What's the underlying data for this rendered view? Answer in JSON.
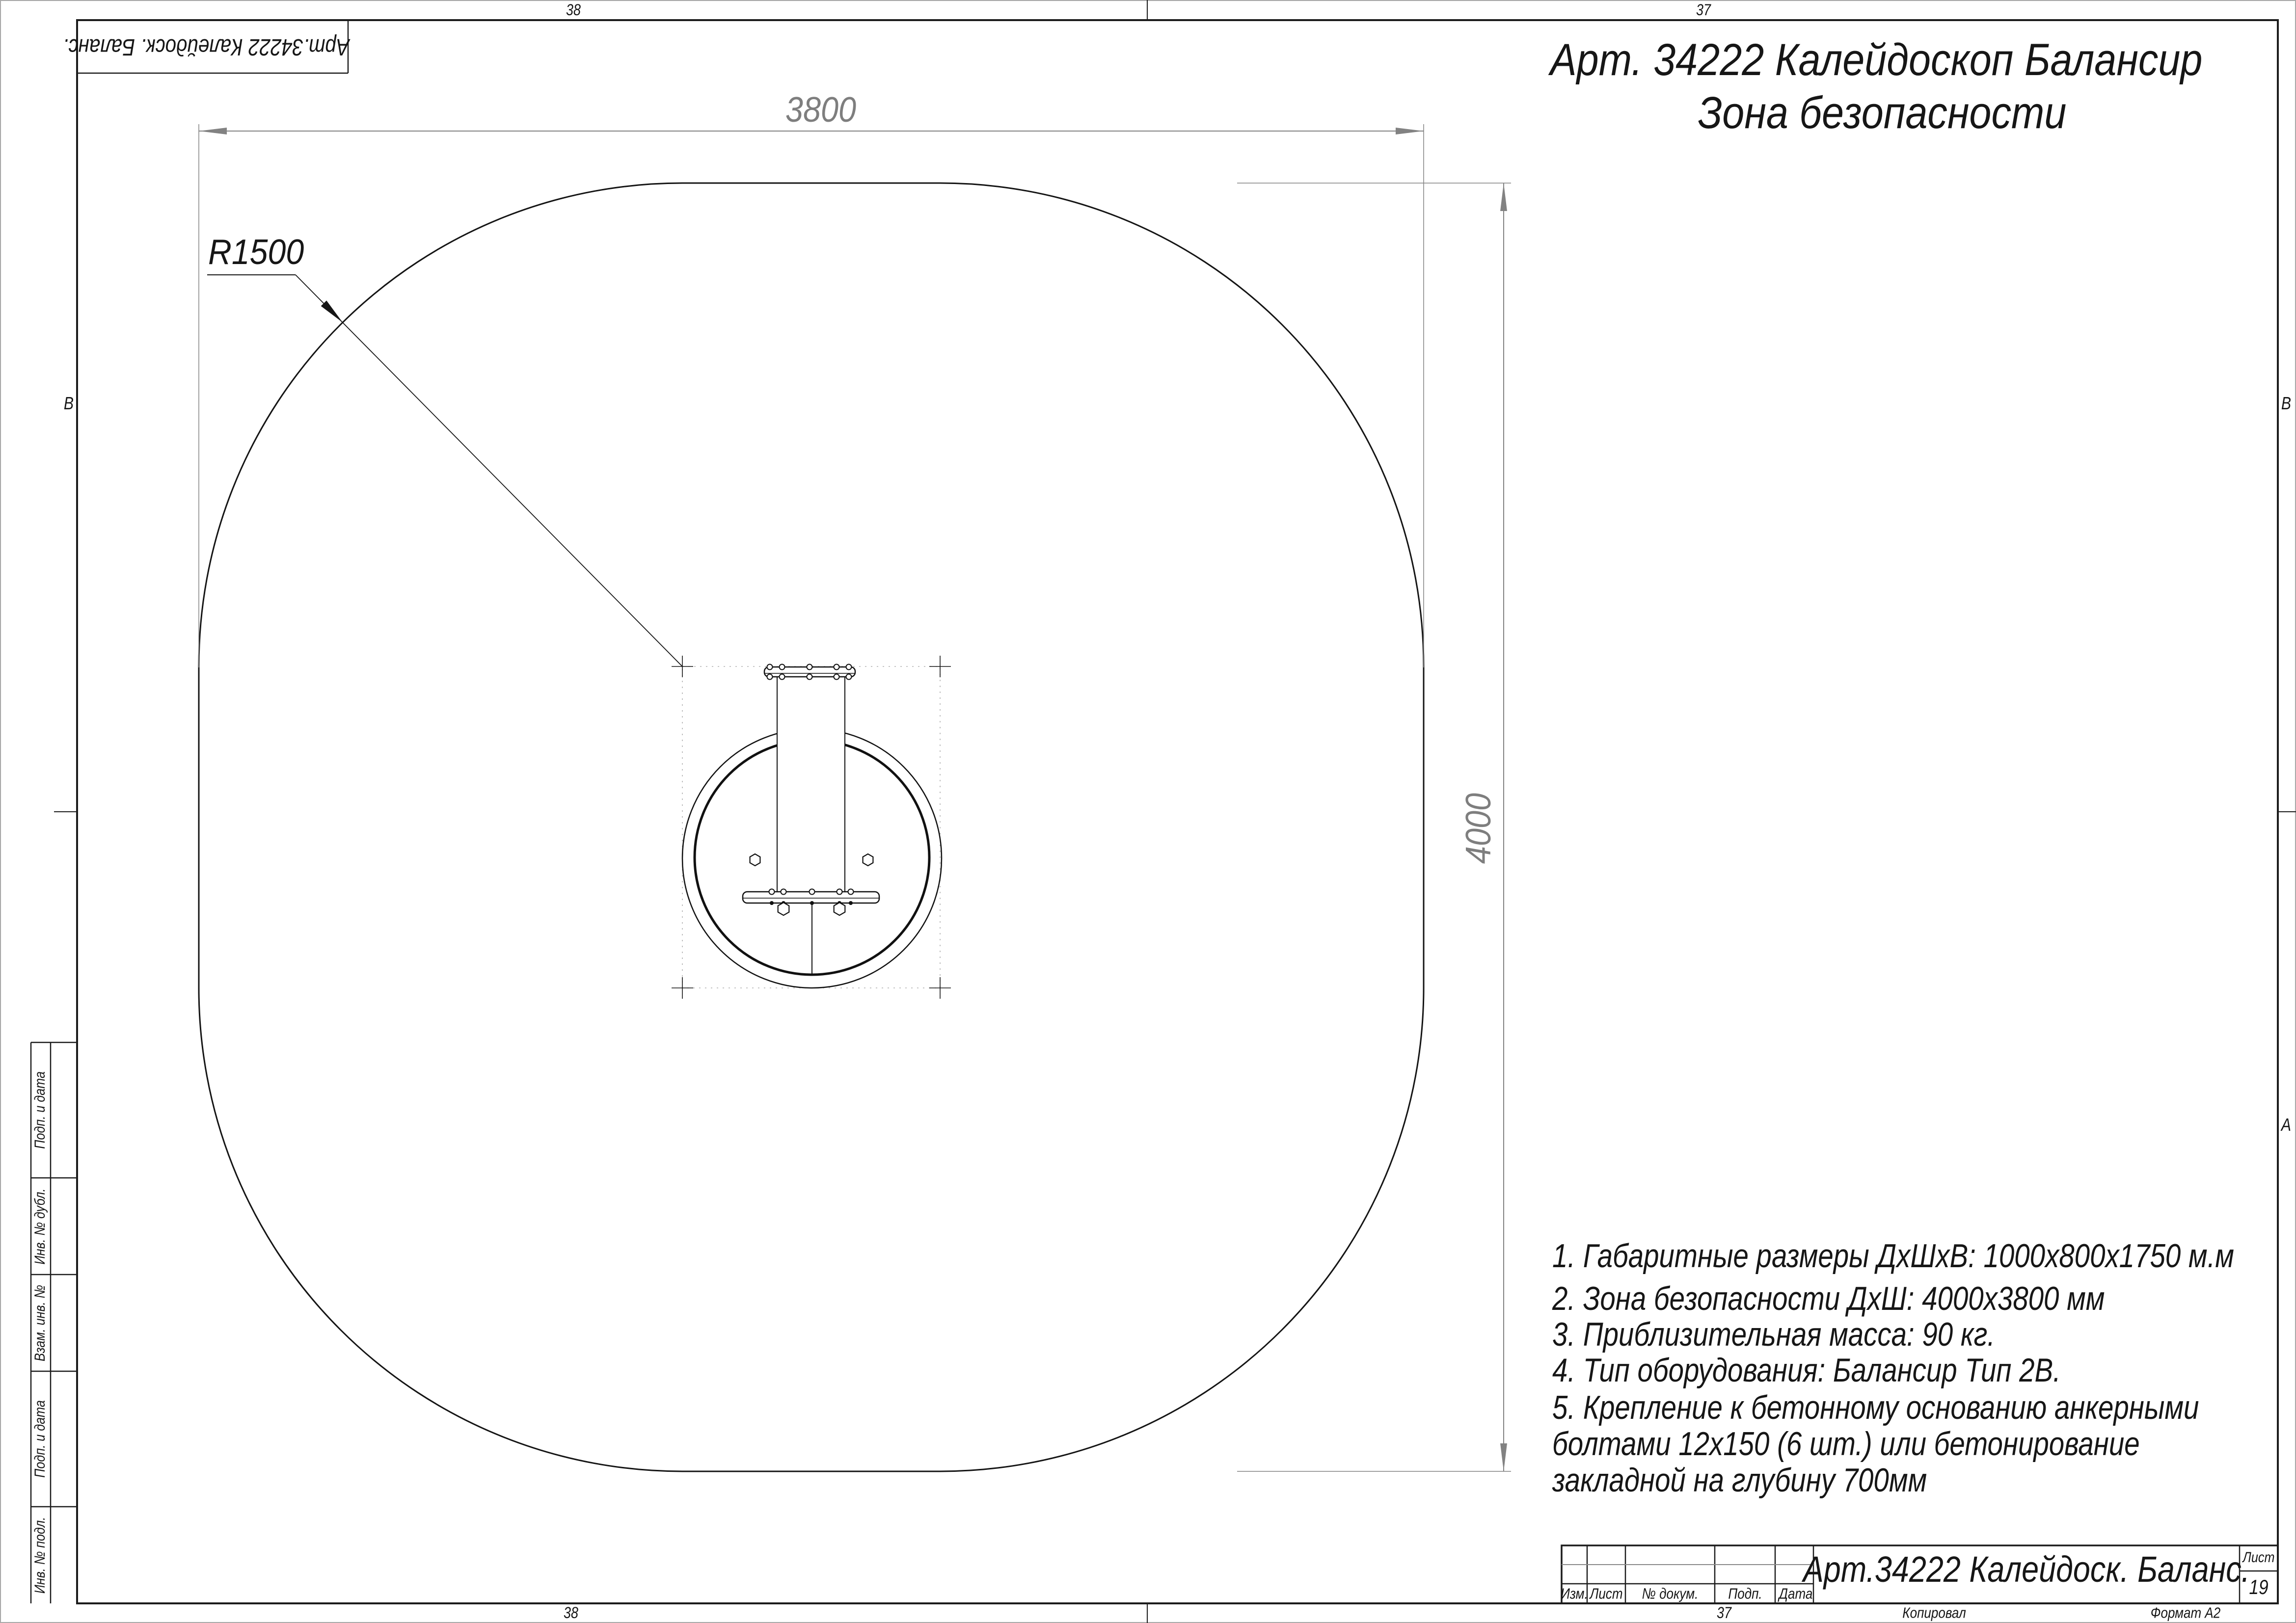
{
  "title": {
    "line1": "Арт. 34222 Калейдоскоп Балансир",
    "line2": "Зона безопасности"
  },
  "dimensions": {
    "width": "3800",
    "height": "4000",
    "radius": "R1500"
  },
  "safety_zone": {
    "width_mm": 3800,
    "height_mm": 4000,
    "corner_radius_mm": 1500
  },
  "notes": {
    "lines": [
      "1. Габаритные размеры ДхШхВ: 1000х800х1750 м.м",
      "2. Зона безопасности ДхШ: 4000х3800 мм",
      "3. Приблизительная масса: 90 кг.",
      "4. Тип оборудования: Балансир Тип 2В.",
      "5. Крепление к бетонному основанию анкерными",
      "болтами 12х150 (6 шт.) или бетонирование",
      "закладной на глубину 700мм"
    ]
  },
  "corner_stamp": {
    "text": "Арт.34222 Калейдоск. Баланс."
  },
  "side_stamps": [
    "Подп. и дата",
    "Инв. № дубл.",
    "Взам. инв. №",
    "Подп. и дата",
    "Инв. № подл."
  ],
  "title_block": {
    "designation": "Арт.34222 Калейдоск. Баланс.",
    "columns": [
      "Изм.",
      "Лист",
      "№ докум.",
      "Подп.",
      "Дата"
    ],
    "sheet_label": "Лист",
    "sheet_number": "19"
  },
  "sheet": {
    "zones": {
      "top_left": "38",
      "top_right": "37",
      "bottom_left": "38",
      "bottom_right": "37"
    },
    "letters": {
      "left_b": "В",
      "right_b": "В",
      "right_a": "А"
    }
  },
  "footer": {
    "copied_label": "Копировал",
    "format_label": "Формат А2"
  },
  "colors": {
    "line": "#1a1a1a",
    "dimension": "#7e7e7e",
    "construction": "#b0b0b0"
  }
}
